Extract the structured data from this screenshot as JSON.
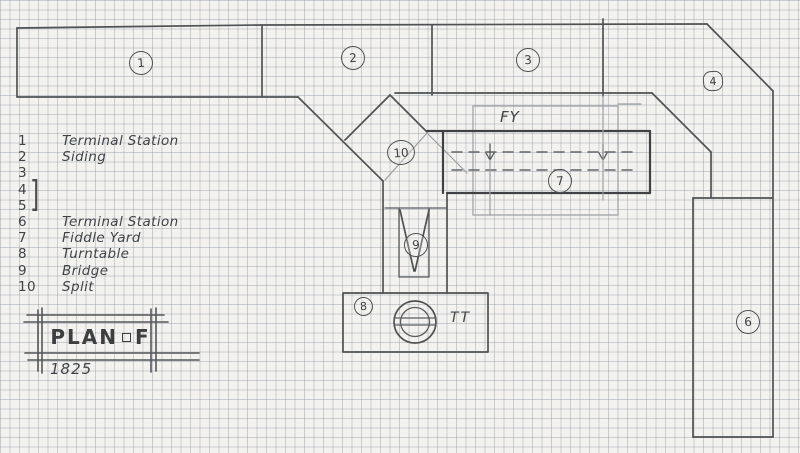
{
  "plan": {
    "title": {
      "left": "PLAN",
      "right": "F",
      "year": "1825"
    },
    "legend": {
      "items": [
        {
          "num": "1",
          "label": "Terminal Station"
        },
        {
          "num": "2",
          "label": "Siding"
        },
        {
          "num": "3",
          "label": ""
        },
        {
          "num": "4",
          "label": ""
        },
        {
          "num": "5",
          "label": ""
        },
        {
          "num": "6",
          "label": "Terminal Station"
        },
        {
          "num": "7",
          "label": "Fiddle Yard"
        },
        {
          "num": "8",
          "label": "Turntable"
        },
        {
          "num": "9",
          "label": "Bridge"
        },
        {
          "num": "10",
          "label": "Split"
        }
      ],
      "bracket": "]"
    },
    "markers": {
      "s1": "1",
      "s2": "2",
      "s3": "3",
      "s4": "4",
      "s6": "6",
      "s7": "7",
      "s8": "8",
      "s9": "9",
      "s10": "10"
    },
    "annotations": {
      "fiddle_yard": "FY",
      "turntable": "TT"
    },
    "colors": {
      "pencil": "#4f5254",
      "pencil_heavy": "#3f4143",
      "pencil_light": "#9aa0a5",
      "paper": "#f3f2ef",
      "grid": "#8c959b"
    }
  }
}
